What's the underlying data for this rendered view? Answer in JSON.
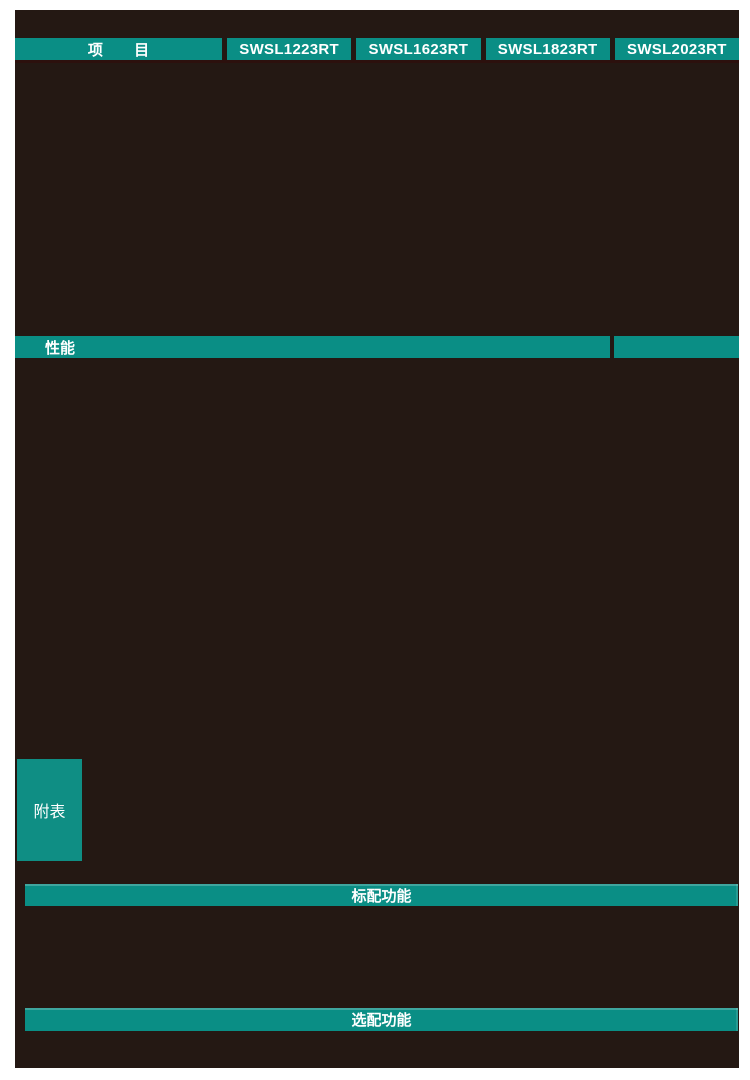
{
  "colors": {
    "page_background": "#ffffff",
    "panel_background": "#241813",
    "accent_teal": "#0a8e85",
    "header_divider": "#2c100d",
    "text_on_teal": "#ffffff"
  },
  "header": {
    "item_label": "项 目",
    "models": [
      {
        "label": "SWSL1223RT"
      },
      {
        "label": "SWSL1623RT"
      },
      {
        "label": "SWSL1823RT"
      },
      {
        "label": "SWSL2023RT"
      }
    ]
  },
  "sections": {
    "performance_label": "性能",
    "appendix_label": "附表",
    "standard_features_label": "标配功能",
    "optional_features_label": "选配功能"
  }
}
